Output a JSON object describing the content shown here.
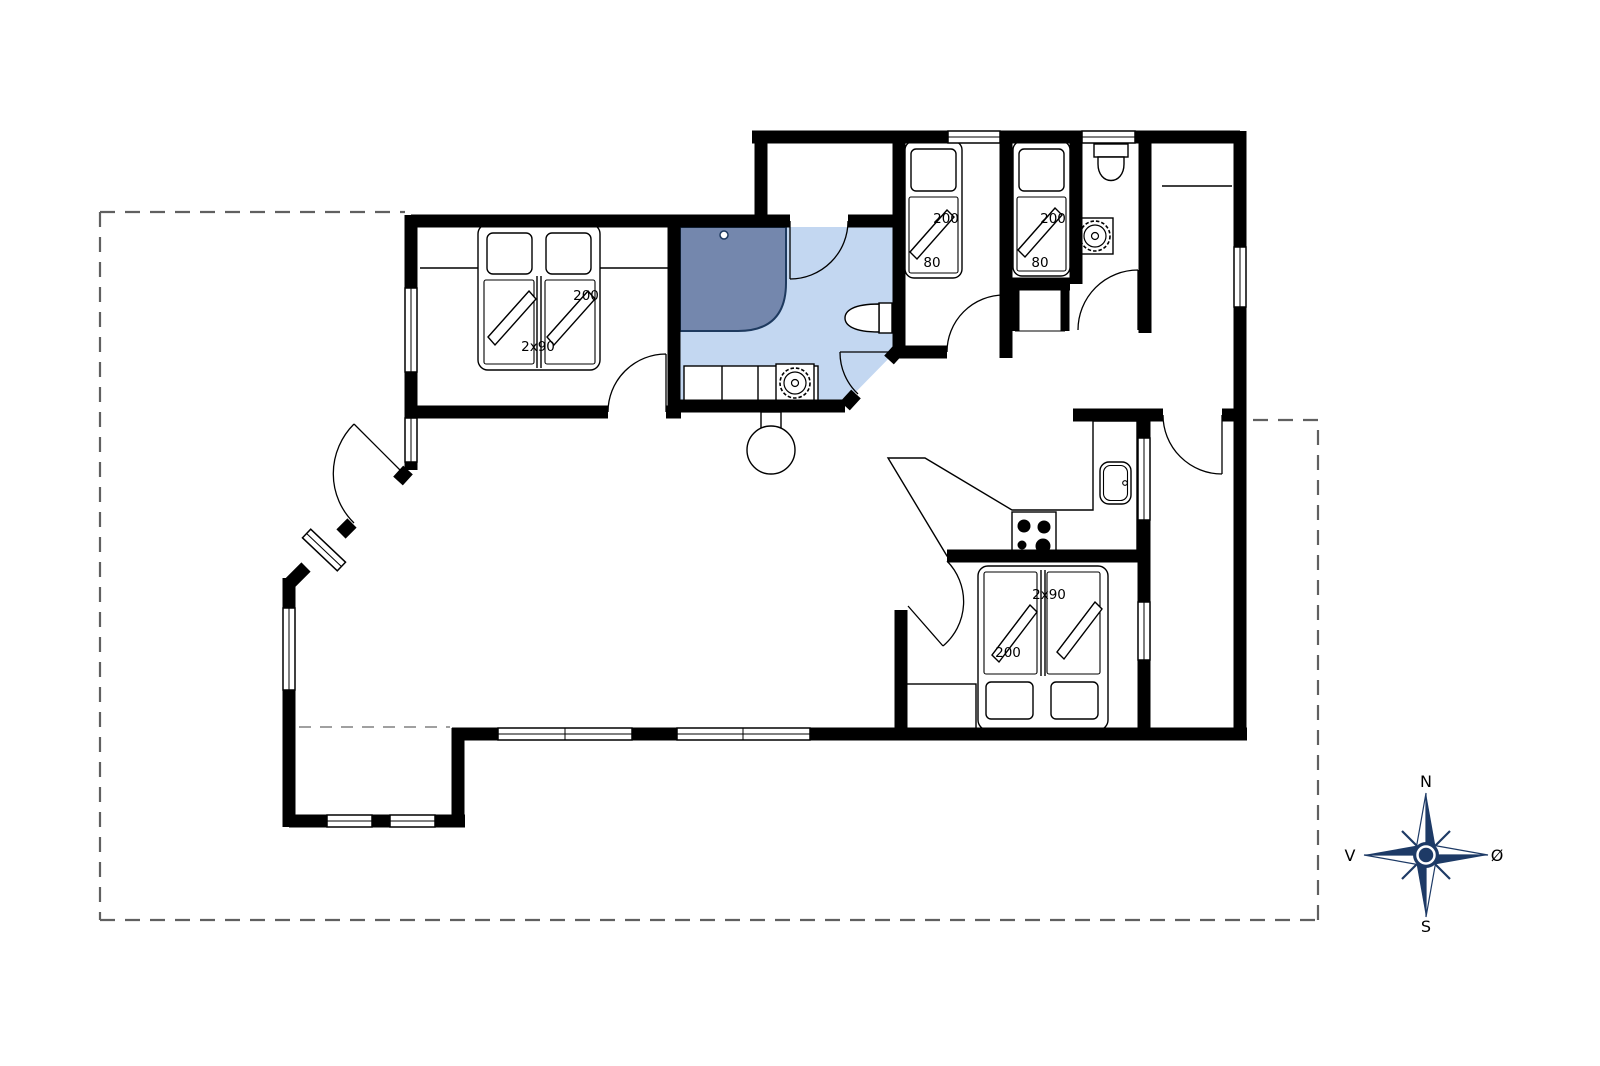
{
  "title": "Holiday house floor plan",
  "colors": {
    "wall": "#000000",
    "background": "#ffffff",
    "bathroom_floor": "#c3d7f1",
    "shower": "#7487ad",
    "fixture_outline": "#1e3a5f",
    "compass": "#1d3a66",
    "dashed_outline": "#606060"
  },
  "labels": {
    "bedroom_left": {
      "length": "200",
      "width": "2x90"
    },
    "bedroom_small_left": {
      "length": "200",
      "width": "80"
    },
    "bedroom_small_right": {
      "length": "200",
      "width": "80"
    },
    "bedroom_se": {
      "width": "2x90",
      "length": "200"
    }
  },
  "compass": {
    "north": "N",
    "south": "S",
    "west": "V",
    "east": "Ø"
  }
}
